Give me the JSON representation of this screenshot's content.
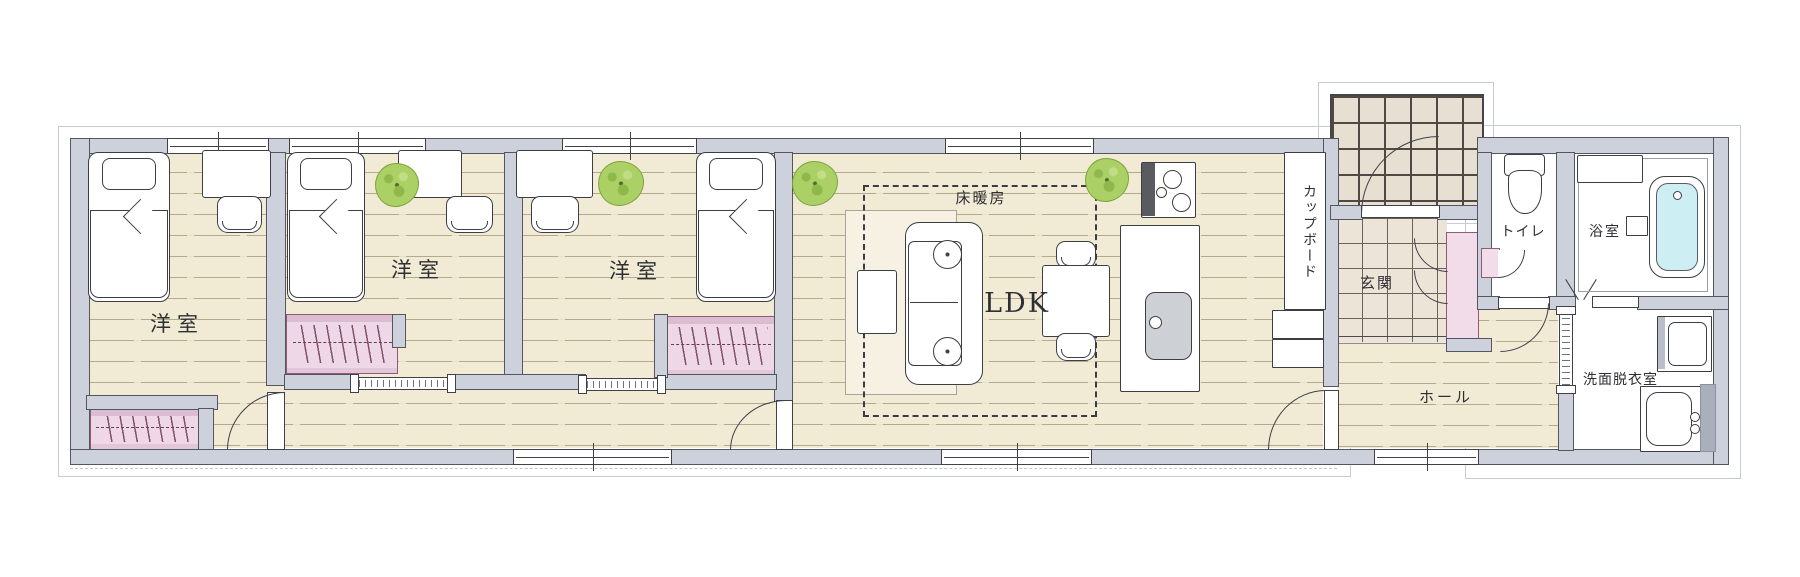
{
  "plan_type": "floor-plan",
  "rooms": [
    {
      "id": "bedroom-1",
      "label": "洋室",
      "fixtures": [
        "single-bed",
        "desk",
        "chair",
        "closet"
      ]
    },
    {
      "id": "bedroom-2",
      "label": "洋室",
      "fixtures": [
        "single-bed",
        "desk",
        "chair",
        "potted-plant",
        "closet"
      ]
    },
    {
      "id": "bedroom-3",
      "label": "洋室",
      "fixtures": [
        "single-bed",
        "desk",
        "chair",
        "potted-plant",
        "closet"
      ]
    },
    {
      "id": "ldk",
      "label": "LDK",
      "fixtures": [
        "sofa",
        "rug",
        "side-table",
        "dining-table",
        "dining-chairs",
        "potted-plant",
        "kitchen-counter",
        "stove",
        "kitchen-sink"
      ]
    },
    {
      "id": "floor-heating",
      "label": "床暖房",
      "fixtures": [
        "floor-heating-dashed-outline"
      ]
    },
    {
      "id": "cupboard",
      "label": "カップボード",
      "fixtures": [
        "cupboard",
        "refrigerator"
      ]
    },
    {
      "id": "entrance",
      "label": "玄関",
      "fixtures": [
        "porch-tiles",
        "entrance-door",
        "shoe-closet"
      ]
    },
    {
      "id": "hall",
      "label": "ホール",
      "fixtures": []
    },
    {
      "id": "toilet",
      "label": "トイレ",
      "fixtures": [
        "toilet-bowl",
        "corner-basin"
      ]
    },
    {
      "id": "bathroom",
      "label": "浴室",
      "fixtures": [
        "bathtub",
        "bath-bench"
      ]
    },
    {
      "id": "washroom",
      "label": "洗面脱衣室",
      "fixtures": [
        "washing-machine",
        "vanity-sink"
      ]
    }
  ],
  "colors": {
    "wall_fill": "#cdd1db",
    "wall_line": "#54565f",
    "wood_floor": "#f1ebd5",
    "plank_line": "#b3aa8e",
    "closet_pink": "#eed7e6",
    "tile_beige": "#ece4d7",
    "bath_water": "#cdeef3",
    "plant_green": "#abd065",
    "rug_cream": "#f6f1e2",
    "text": "#2e2f33"
  }
}
